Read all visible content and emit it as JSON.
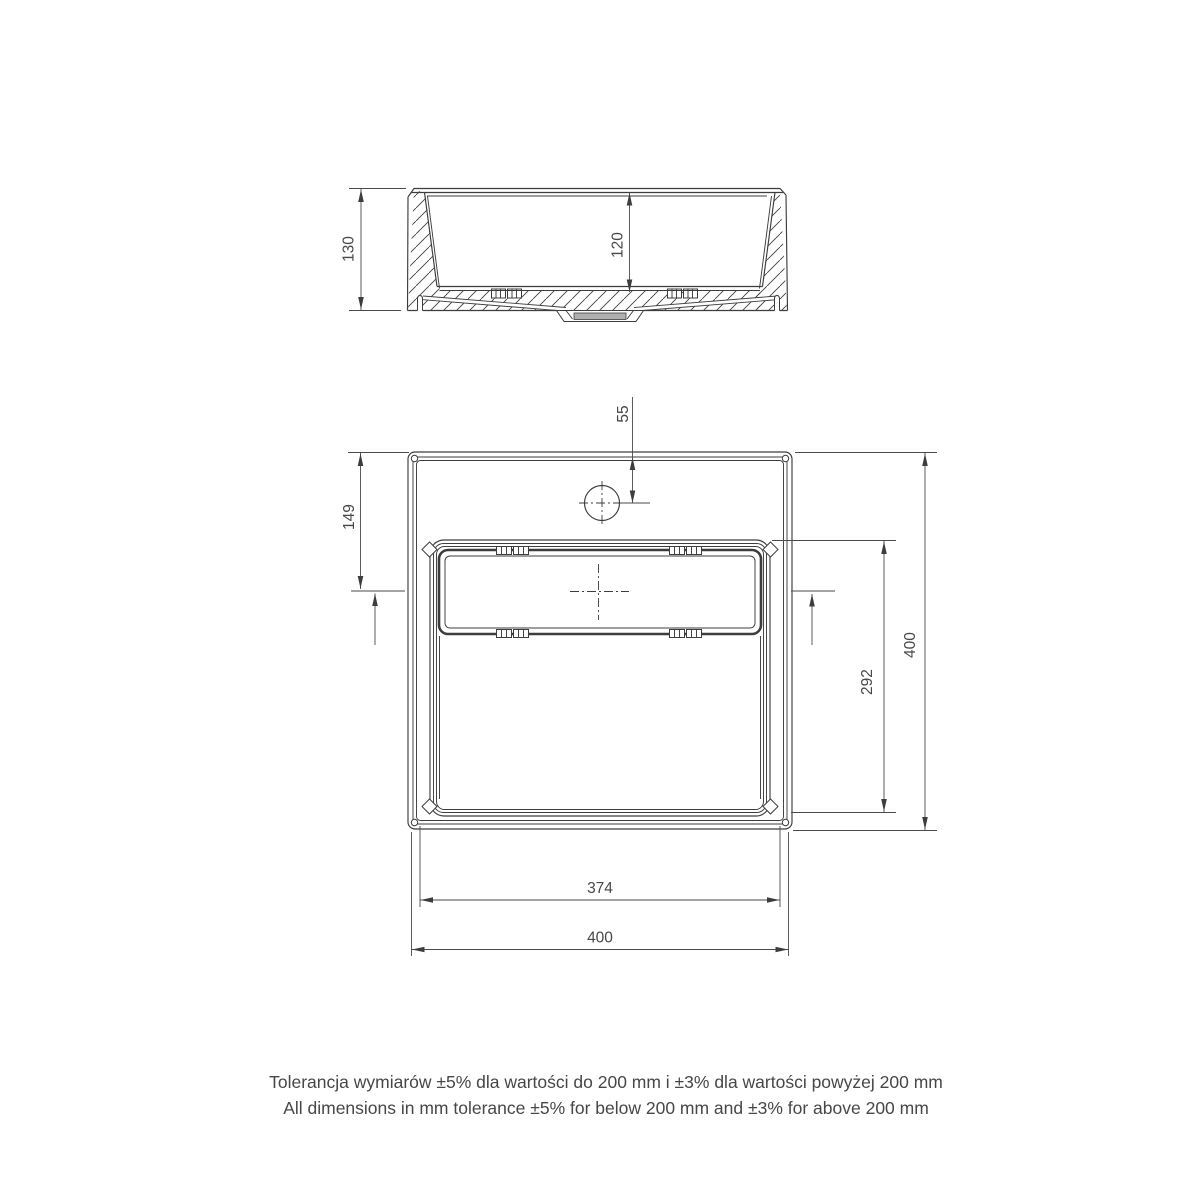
{
  "section_view": {
    "dim_overall_height": "130",
    "dim_basin_depth": "120"
  },
  "plan_view": {
    "dim_faucet_to_edge": "55",
    "dim_edge_to_drain_axis": "149",
    "dim_basin_length": "292",
    "dim_overall_depth": "400",
    "dim_basin_width": "374",
    "dim_overall_width": "400"
  },
  "footer": {
    "tolerance_pl": "Tolerancja wymiarów ±5% dla wartości do 200 mm i ±3% dla wartości powyżej 200 mm",
    "tolerance_en": "All dimensions in mm tolerance ±5% for below 200 mm and ±3% for above 200 mm"
  },
  "colors": {
    "line": "#3d3d3d",
    "dimension": "#4a4a4a",
    "text": "#474747",
    "drain_fill": "#b0b0b0",
    "background": "#ffffff"
  }
}
